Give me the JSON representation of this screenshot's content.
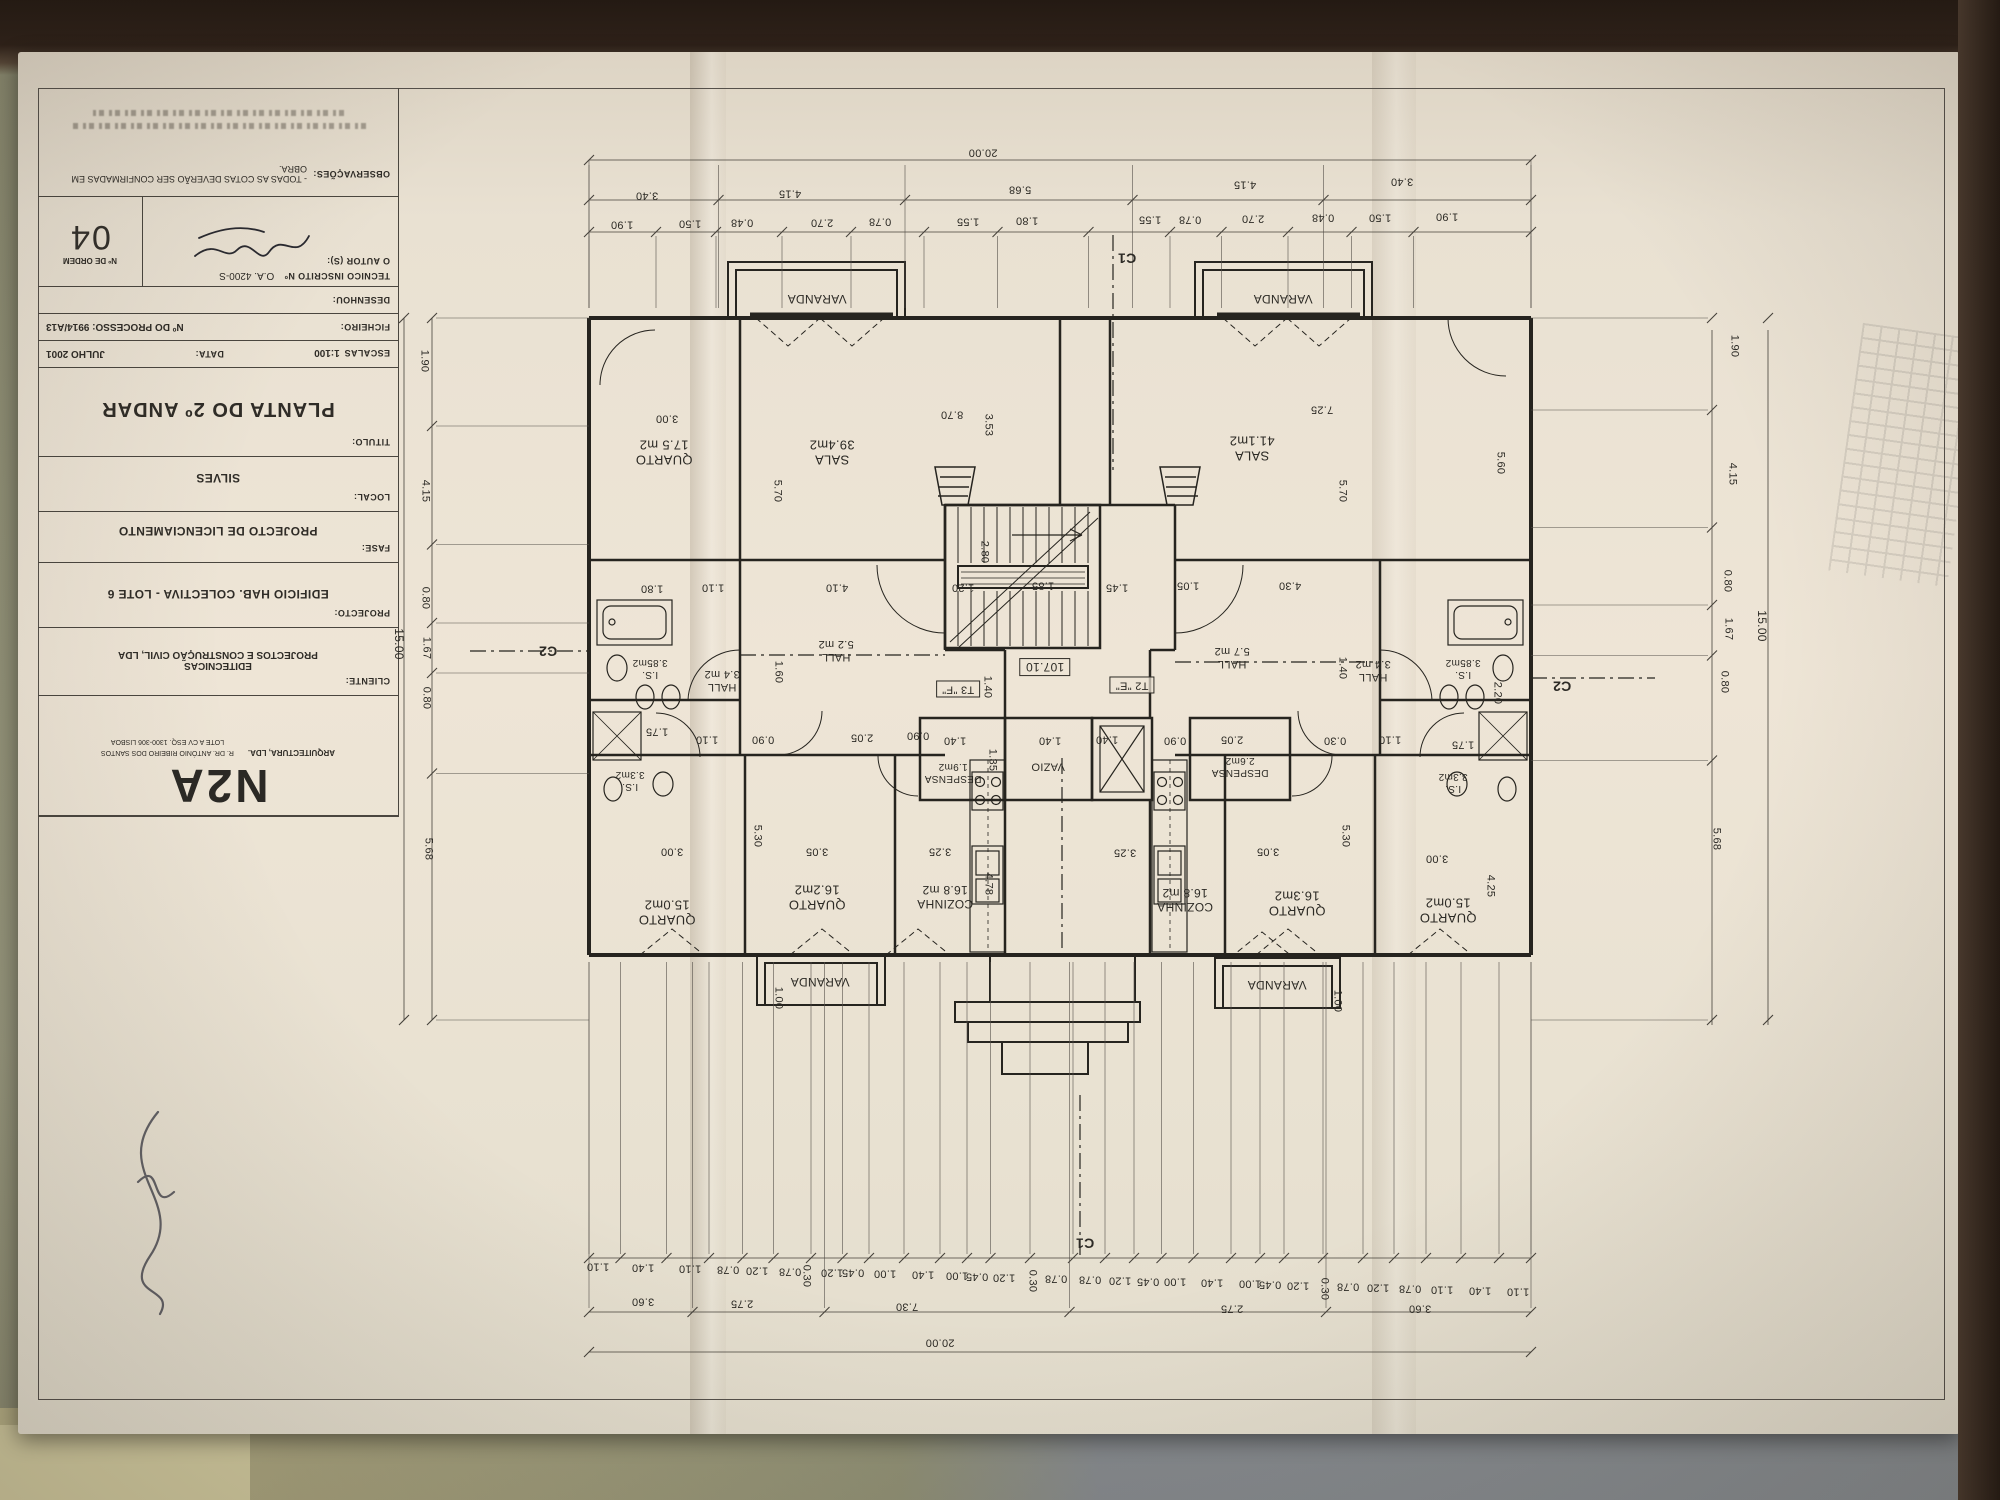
{
  "scene": {
    "paper_color": "#e9e1d2",
    "ink_color": "#26241f",
    "table_color": "#8c8c6e",
    "folder_color": "#878c90"
  },
  "title_block": {
    "observacoes_label": "OBSERVAÇÕES:",
    "observacoes_text": "- TODAS AS COTAS DEVERÃO SER CONFIRMADAS EM OBRA.",
    "tecnico_label": "TECNICO INSCRITO Nº",
    "tecnico_value": "O.A. 4200-S",
    "ordem_label": "Nº DE ORDEM",
    "ordem_value": "04",
    "autor_label": "O AUTOR (S):",
    "desenhou_label": "DESENHOU:",
    "ficheiro_label": "FICHEIRO:",
    "processo_value": "Nº DO PROCESSO: 9914/A13",
    "escalas_label": "ESCALAS",
    "escalas_value": "1:100",
    "data_label": "DATA:",
    "data_value": "JULHO 2001",
    "titulo_label": "TITULO:",
    "titulo_value": "PLANTA DO 2º ANDAR",
    "local_label": "LOCAL:",
    "local_value": "SILVES",
    "fase_label": "FASE:",
    "fase_value": "PROJECTO DE LICENCIAMENTO",
    "projecto_label": "PROJECTO:",
    "projecto_value": "EDIFICIO  HAB. COLECTIVA - LOTE 6",
    "cliente_label": "CLIENTE:",
    "cliente_value": "EDITECNICAS\nPROJECTOS E CONSTRUÇÃO CIVIL, LDA",
    "logo_text": "N2A",
    "logo_sub": "ARQUITECTURA, LDA.",
    "logo_addr1": "R. DR. ANTÓNIO RIBEIRO DOS SANTOS",
    "logo_addr2": "LOTE A  CV ESQ.  1300-306 LISBOA"
  },
  "plan": {
    "level_mark": "107.10",
    "unit_marks": [
      "T3 \"F\"",
      "T2 \"E\""
    ],
    "labels": [
      {
        "t": "VARANDA",
        "x": 817,
        "y": 299,
        "s": 12
      },
      {
        "t": "VARANDA",
        "x": 1283,
        "y": 299,
        "s": 12
      },
      {
        "t": "QUARTO\n17.5 m2",
        "x": 664,
        "y": 452,
        "s": 13
      },
      {
        "t": "SALA\n39.4m2",
        "x": 832,
        "y": 452,
        "s": 13
      },
      {
        "t": "SALA\n41.1m2",
        "x": 1252,
        "y": 448,
        "s": 13
      },
      {
        "t": "I.S.\n3.85m2",
        "x": 650,
        "y": 668,
        "s": 10
      },
      {
        "t": "HALL\n3.4 m2",
        "x": 722,
        "y": 680,
        "s": 11
      },
      {
        "t": "HALL\n5.2 m2",
        "x": 836,
        "y": 650,
        "s": 11
      },
      {
        "t": "HALL\n5.7 m2",
        "x": 1232,
        "y": 657,
        "s": 11
      },
      {
        "t": "HALL\n3.4 m2",
        "x": 1373,
        "y": 670,
        "s": 11
      },
      {
        "t": "I.S.\n3.85m2",
        "x": 1463,
        "y": 668,
        "s": 10
      },
      {
        "t": "I.S.\n3.3m2",
        "x": 630,
        "y": 780,
        "s": 10
      },
      {
        "t": "I.S.\n3.3m2",
        "x": 1453,
        "y": 782,
        "s": 10
      },
      {
        "t": "DESPENSA\n1.9m2",
        "x": 953,
        "y": 772,
        "s": 10
      },
      {
        "t": "DESPENSA\n2.6m2",
        "x": 1240,
        "y": 766,
        "s": 10
      },
      {
        "t": "VAZIO",
        "x": 1048,
        "y": 766,
        "s": 11
      },
      {
        "t": "QUARTO\n15.0m2",
        "x": 667,
        "y": 912,
        "s": 13
      },
      {
        "t": "QUARTO\n16.2m2",
        "x": 817,
        "y": 897,
        "s": 13
      },
      {
        "t": "COZINHA\n16.8 m2",
        "x": 945,
        "y": 897,
        "s": 12
      },
      {
        "t": "COZINHA\n16.8 m2",
        "x": 1185,
        "y": 900,
        "s": 12
      },
      {
        "t": "QUARTO\n16.3m2",
        "x": 1297,
        "y": 903,
        "s": 13
      },
      {
        "t": "QUARTO\n15.0m2",
        "x": 1448,
        "y": 910,
        "s": 13
      },
      {
        "t": "VARANDA",
        "x": 820,
        "y": 982,
        "s": 12
      },
      {
        "t": "VARANDA",
        "x": 1277,
        "y": 985,
        "s": 12
      },
      {
        "t": "107.10",
        "x": 1045,
        "y": 667,
        "s": 12,
        "box": true
      },
      {
        "t": "T3 \"F\"",
        "x": 958,
        "y": 689,
        "s": 11,
        "box": true
      },
      {
        "t": "T2 \"E\"",
        "x": 1132,
        "y": 685,
        "s": 11,
        "box": true
      },
      {
        "t": "C1",
        "x": 1127,
        "y": 258,
        "s": 14,
        "b": true
      },
      {
        "t": "C1",
        "x": 1085,
        "y": 1243,
        "s": 14,
        "b": true
      },
      {
        "t": "C2",
        "x": 548,
        "y": 651,
        "s": 14,
        "b": true
      },
      {
        "t": "C2",
        "x": 1562,
        "y": 686,
        "s": 14,
        "b": true
      },
      {
        "t": "20.00",
        "x": 983,
        "y": 152
      },
      {
        "t": "3.40",
        "x": 647,
        "y": 195
      },
      {
        "t": "4.15",
        "x": 790,
        "y": 193
      },
      {
        "t": "5.68",
        "x": 1020,
        "y": 189
      },
      {
        "t": "4.15",
        "x": 1245,
        "y": 184
      },
      {
        "t": "3.40",
        "x": 1402,
        "y": 181
      },
      {
        "t": "1.90",
        "x": 622,
        "y": 224
      },
      {
        "t": "1.50",
        "x": 690,
        "y": 223
      },
      {
        "t": "0.48",
        "x": 742,
        "y": 222
      },
      {
        "t": "2.70",
        "x": 822,
        "y": 222
      },
      {
        "t": "0.78",
        "x": 880,
        "y": 221
      },
      {
        "t": "1.55",
        "x": 968,
        "y": 221
      },
      {
        "t": "1.80",
        "x": 1027,
        "y": 220
      },
      {
        "t": "1.55",
        "x": 1150,
        "y": 219
      },
      {
        "t": "0.78",
        "x": 1190,
        "y": 219
      },
      {
        "t": "2.70",
        "x": 1253,
        "y": 218
      },
      {
        "t": "0.48",
        "x": 1323,
        "y": 217
      },
      {
        "t": "1.50",
        "x": 1380,
        "y": 217
      },
      {
        "t": "1.90",
        "x": 1447,
        "y": 216
      },
      {
        "t": "20.00",
        "x": 940,
        "y": 1342
      },
      {
        "t": "3.60",
        "x": 643,
        "y": 1301
      },
      {
        "t": "2.75",
        "x": 742,
        "y": 1303
      },
      {
        "t": "7.30",
        "x": 907,
        "y": 1306
      },
      {
        "t": "2.75",
        "x": 1232,
        "y": 1308
      },
      {
        "t": "3.60",
        "x": 1420,
        "y": 1308
      },
      {
        "t": "1.10",
        "x": 598,
        "y": 1266
      },
      {
        "t": "1.40",
        "x": 643,
        "y": 1267
      },
      {
        "t": "1.10",
        "x": 690,
        "y": 1268
      },
      {
        "t": "0.78",
        "x": 728,
        "y": 1269
      },
      {
        "t": "1.20",
        "x": 757,
        "y": 1270
      },
      {
        "t": "0.78",
        "x": 790,
        "y": 1271
      },
      {
        "t": "0.30",
        "x": 806,
        "y": 1276,
        "r": 90
      },
      {
        "t": "1.20",
        "x": 832,
        "y": 1272
      },
      {
        "t": "0.45",
        "x": 853,
        "y": 1272
      },
      {
        "t": "1.00",
        "x": 885,
        "y": 1273
      },
      {
        "t": "1.40",
        "x": 923,
        "y": 1274
      },
      {
        "t": "1.00",
        "x": 957,
        "y": 1275
      },
      {
        "t": "0.45",
        "x": 977,
        "y": 1276
      },
      {
        "t": "1.20",
        "x": 1004,
        "y": 1277
      },
      {
        "t": "0.30",
        "x": 1032,
        "y": 1281,
        "r": 90
      },
      {
        "t": "0.78",
        "x": 1056,
        "y": 1278
      },
      {
        "t": "0.78",
        "x": 1090,
        "y": 1279
      },
      {
        "t": "1.20",
        "x": 1120,
        "y": 1280
      },
      {
        "t": "0.45",
        "x": 1148,
        "y": 1281
      },
      {
        "t": "1.00",
        "x": 1175,
        "y": 1281
      },
      {
        "t": "1.40",
        "x": 1212,
        "y": 1282
      },
      {
        "t": "1.00",
        "x": 1250,
        "y": 1283
      },
      {
        "t": "0.45",
        "x": 1270,
        "y": 1284
      },
      {
        "t": "1.20",
        "x": 1298,
        "y": 1285
      },
      {
        "t": "0.30",
        "x": 1324,
        "y": 1289,
        "r": 90
      },
      {
        "t": "0.78",
        "x": 1348,
        "y": 1286
      },
      {
        "t": "1.20",
        "x": 1378,
        "y": 1287
      },
      {
        "t": "0.78",
        "x": 1410,
        "y": 1288
      },
      {
        "t": "1.10",
        "x": 1442,
        "y": 1289
      },
      {
        "t": "1.40",
        "x": 1480,
        "y": 1290
      },
      {
        "t": "1.10",
        "x": 1518,
        "y": 1291
      },
      {
        "t": "1.90",
        "x": 424,
        "y": 361,
        "r": 90
      },
      {
        "t": "4.15",
        "x": 425,
        "y": 491,
        "r": 90
      },
      {
        "t": "0.80",
        "x": 425,
        "y": 598,
        "r": 90
      },
      {
        "t": "1.67",
        "x": 426,
        "y": 648,
        "r": 90
      },
      {
        "t": "0.80",
        "x": 426,
        "y": 698,
        "r": 90
      },
      {
        "t": "5.68",
        "x": 428,
        "y": 849,
        "r": 90
      },
      {
        "t": "15.00",
        "x": 399,
        "y": 644,
        "r": 90,
        "s": 12
      },
      {
        "t": "1.90",
        "x": 1734,
        "y": 346,
        "r": 90
      },
      {
        "t": "4.15",
        "x": 1732,
        "y": 474,
        "r": 90
      },
      {
        "t": "0.80",
        "x": 1727,
        "y": 581,
        "r": 90
      },
      {
        "t": "1.67",
        "x": 1728,
        "y": 629,
        "r": 90
      },
      {
        "t": "0.80",
        "x": 1724,
        "y": 682,
        "r": 90
      },
      {
        "t": "5.68",
        "x": 1716,
        "y": 839,
        "r": 90
      },
      {
        "t": "15.00",
        "x": 1762,
        "y": 626,
        "r": 90,
        "s": 12
      },
      {
        "t": "3.00",
        "x": 667,
        "y": 418
      },
      {
        "t": "5.70",
        "x": 777,
        "y": 491,
        "r": 90
      },
      {
        "t": "8.70",
        "x": 952,
        "y": 414
      },
      {
        "t": "3.53",
        "x": 988,
        "y": 425,
        "r": 90
      },
      {
        "t": "7.25",
        "x": 1322,
        "y": 409
      },
      {
        "t": "5.70",
        "x": 1342,
        "y": 491,
        "r": 90
      },
      {
        "t": "5.60",
        "x": 1500,
        "y": 463,
        "r": 90
      },
      {
        "t": "1.80",
        "x": 652,
        "y": 588
      },
      {
        "t": "1.10",
        "x": 713,
        "y": 587
      },
      {
        "t": "4.10",
        "x": 837,
        "y": 587
      },
      {
        "t": "1.20",
        "x": 963,
        "y": 587
      },
      {
        "t": "2.80",
        "x": 984,
        "y": 552,
        "r": 90
      },
      {
        "t": "1.85",
        "x": 1043,
        "y": 585
      },
      {
        "t": "1.45",
        "x": 1117,
        "y": 587
      },
      {
        "t": "1.05",
        "x": 1188,
        "y": 585
      },
      {
        "t": "4.30",
        "x": 1290,
        "y": 585
      },
      {
        "t": "1.60",
        "x": 778,
        "y": 672,
        "r": 90
      },
      {
        "t": "1.40",
        "x": 987,
        "y": 687,
        "r": 90
      },
      {
        "t": "1.40",
        "x": 1342,
        "y": 668,
        "r": 90
      },
      {
        "t": "2.20",
        "x": 1497,
        "y": 693,
        "r": 90
      },
      {
        "t": "1.75",
        "x": 657,
        "y": 731
      },
      {
        "t": "1.10",
        "x": 707,
        "y": 739
      },
      {
        "t": "0.90",
        "x": 763,
        "y": 739
      },
      {
        "t": "2.05",
        "x": 862,
        "y": 737
      },
      {
        "t": "0.90",
        "x": 918,
        "y": 735
      },
      {
        "t": "1.40",
        "x": 955,
        "y": 740
      },
      {
        "t": "1.35",
        "x": 992,
        "y": 760,
        "r": 90
      },
      {
        "t": "1.40",
        "x": 1050,
        "y": 740
      },
      {
        "t": "1.40",
        "x": 1107,
        "y": 739
      },
      {
        "t": "0.90",
        "x": 1175,
        "y": 740
      },
      {
        "t": "2.05",
        "x": 1232,
        "y": 739
      },
      {
        "t": "0.30",
        "x": 1335,
        "y": 740
      },
      {
        "t": "1.10",
        "x": 1390,
        "y": 739
      },
      {
        "t": "1.75",
        "x": 1463,
        "y": 744
      },
      {
        "t": "5.30",
        "x": 757,
        "y": 836,
        "r": 90
      },
      {
        "t": "5.30",
        "x": 1345,
        "y": 836,
        "r": 90
      },
      {
        "t": "3.00",
        "x": 672,
        "y": 851
      },
      {
        "t": "3.05",
        "x": 817,
        "y": 851
      },
      {
        "t": "3.25",
        "x": 940,
        "y": 851
      },
      {
        "t": "3.25",
        "x": 1125,
        "y": 852
      },
      {
        "t": "3.05",
        "x": 1268,
        "y": 851
      },
      {
        "t": "3.00",
        "x": 1437,
        "y": 858
      },
      {
        "t": "4.78",
        "x": 988,
        "y": 884,
        "r": 90
      },
      {
        "t": "4.25",
        "x": 1490,
        "y": 886,
        "r": 90
      },
      {
        "t": "1.00",
        "x": 778,
        "y": 998,
        "r": 90
      },
      {
        "t": "1.00",
        "x": 1337,
        "y": 1001,
        "r": 90
      }
    ]
  }
}
